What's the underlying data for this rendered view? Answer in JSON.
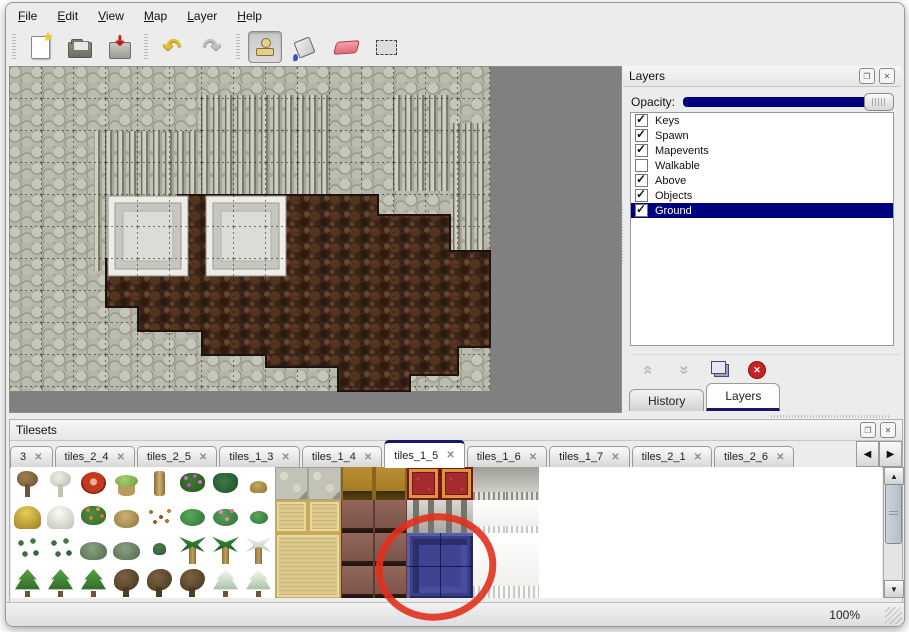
{
  "window": {
    "zoom_level": "100%"
  },
  "menu_bar": {
    "items": [
      "File",
      "Edit",
      "View",
      "Map",
      "Layer",
      "Help"
    ]
  },
  "toolbar": {
    "groups": [
      {
        "buttons": [
          {
            "icon": "new-file"
          },
          {
            "icon": "open-folder"
          },
          {
            "icon": "save"
          }
        ]
      },
      {
        "buttons": [
          {
            "icon": "undo",
            "glyph": "↶"
          },
          {
            "icon": "redo",
            "glyph": "↷"
          }
        ]
      },
      {
        "buttons": [
          {
            "icon": "stamp",
            "pressed": true
          },
          {
            "icon": "bucket"
          },
          {
            "icon": "eraser"
          },
          {
            "icon": "select"
          }
        ]
      }
    ]
  },
  "layers_panel": {
    "title": "Layers",
    "opacity_label": "Opacity:",
    "opacity_value": 1.0,
    "layers": [
      {
        "name": "Keys",
        "checked": true,
        "selected": false
      },
      {
        "name": "Spawn",
        "checked": true,
        "selected": false
      },
      {
        "name": "Mapevents",
        "checked": true,
        "selected": false
      },
      {
        "name": "Walkable",
        "checked": false,
        "selected": false
      },
      {
        "name": "Above",
        "checked": true,
        "selected": false
      },
      {
        "name": "Objects",
        "checked": true,
        "selected": false
      },
      {
        "name": "Ground",
        "checked": true,
        "selected": true
      }
    ],
    "buttons": [
      {
        "icon": "raise-layer",
        "disabled": true
      },
      {
        "icon": "lower-layer",
        "disabled": true
      },
      {
        "icon": "duplicate-layer",
        "disabled": false
      },
      {
        "icon": "delete-layer",
        "disabled": false
      }
    ],
    "tabs": [
      {
        "label": "History",
        "active": false
      },
      {
        "label": "Layers",
        "active": true
      }
    ]
  },
  "tilesets_panel": {
    "title": "Tilesets",
    "tabs": [
      {
        "label": "3",
        "active": false
      },
      {
        "label": "tiles_2_4",
        "active": false
      },
      {
        "label": "tiles_2_5",
        "active": false
      },
      {
        "label": "tiles_1_3",
        "active": false
      },
      {
        "label": "tiles_1_4",
        "active": false
      },
      {
        "label": "tiles_1_5",
        "active": true
      },
      {
        "label": "tiles_1_6",
        "active": false
      },
      {
        "label": "tiles_1_7",
        "active": false
      },
      {
        "label": "tiles_2_1",
        "active": false
      },
      {
        "label": "tiles_2_6",
        "active": false
      }
    ],
    "close_glyph": "✕",
    "scroll_left": "◀",
    "scroll_right": "▶"
  },
  "tileset_grid": {
    "tile_size": 33,
    "tiles": [
      {
        "c": 0,
        "r": 0,
        "t": "tree_dead"
      },
      {
        "c": 1,
        "r": 0,
        "t": "tree_white"
      },
      {
        "c": 2,
        "r": 0,
        "t": "bloom_red"
      },
      {
        "c": 3,
        "r": 0,
        "t": "stump"
      },
      {
        "c": 4,
        "r": 0,
        "t": "trunk"
      },
      {
        "c": 5,
        "r": 0,
        "t": "flowers_purple"
      },
      {
        "c": 6,
        "r": 0,
        "t": "fern"
      },
      {
        "c": 7,
        "r": 0,
        "t": "weed"
      },
      {
        "c": 0,
        "r": 1,
        "t": "hay"
      },
      {
        "c": 1,
        "r": 1,
        "t": "snow_mound"
      },
      {
        "c": 2,
        "r": 1,
        "t": "flowers_orange"
      },
      {
        "c": 3,
        "r": 1,
        "t": "dry_grass"
      },
      {
        "c": 4,
        "r": 1,
        "t": "leaves"
      },
      {
        "c": 5,
        "r": 1,
        "t": "lilypad"
      },
      {
        "c": 6,
        "r": 1,
        "t": "flowers_pink"
      },
      {
        "c": 7,
        "r": 1,
        "t": "lilypad_sm"
      },
      {
        "c": 0,
        "r": 2,
        "t": "sprigs"
      },
      {
        "c": 1,
        "r": 2,
        "t": "sprigs"
      },
      {
        "c": 2,
        "r": 2,
        "t": "bush"
      },
      {
        "c": 3,
        "r": 2,
        "t": "bush"
      },
      {
        "c": 4,
        "r": 2,
        "t": "sprig"
      },
      {
        "c": 5,
        "r": 2,
        "t": "palm"
      },
      {
        "c": 6,
        "r": 2,
        "t": "palm"
      },
      {
        "c": 7,
        "r": 2,
        "t": "palm_snow"
      },
      {
        "c": 0,
        "r": 3,
        "t": "pine"
      },
      {
        "c": 1,
        "r": 3,
        "t": "pine"
      },
      {
        "c": 2,
        "r": 3,
        "t": "pine"
      },
      {
        "c": 3,
        "r": 3,
        "t": "tree_gnarl"
      },
      {
        "c": 4,
        "r": 3,
        "t": "tree_gnarl"
      },
      {
        "c": 5,
        "r": 3,
        "t": "tree_gnarl"
      },
      {
        "c": 6,
        "r": 3,
        "t": "pine_snow"
      },
      {
        "c": 7,
        "r": 3,
        "t": "pine_snow"
      },
      {
        "c": 8,
        "r": 0,
        "t": "stone"
      },
      {
        "c": 9,
        "r": 0,
        "t": "stone"
      },
      {
        "c": 10,
        "r": 0,
        "t": "wood"
      },
      {
        "c": 11,
        "r": 0,
        "t": "wood"
      },
      {
        "c": 12,
        "r": 0,
        "t": "carpet"
      },
      {
        "c": 13,
        "r": 0,
        "t": "carpet"
      },
      {
        "c": 14,
        "r": 0,
        "t": "curtain_gray"
      },
      {
        "c": 15,
        "r": 0,
        "t": "curtain_gray"
      },
      {
        "c": 8,
        "r": 1,
        "t": "tatami"
      },
      {
        "c": 9,
        "r": 1,
        "t": "tatami"
      },
      {
        "c": 10,
        "r": 1,
        "t": "table"
      },
      {
        "c": 11,
        "r": 1,
        "t": "table"
      },
      {
        "c": 12,
        "r": 1,
        "t": "pillar"
      },
      {
        "c": 13,
        "r": 1,
        "t": "pillar"
      },
      {
        "c": 14,
        "r": 1,
        "t": "curtain_white"
      },
      {
        "c": 15,
        "r": 1,
        "t": "curtain_white"
      },
      {
        "c": 8,
        "r": 2,
        "w": 2,
        "h": 2,
        "t": "tatami_big"
      },
      {
        "c": 10,
        "r": 2,
        "t": "table"
      },
      {
        "c": 11,
        "r": 2,
        "t": "table"
      },
      {
        "c": 12,
        "r": 2,
        "w": 2,
        "h": 2,
        "t": "blue_sel",
        "selected": true
      },
      {
        "c": 14,
        "r": 2,
        "w": 2,
        "h": 2,
        "t": "curtain_white_big"
      },
      {
        "c": 10,
        "r": 3,
        "t": "table"
      },
      {
        "c": 11,
        "r": 3,
        "t": "table"
      }
    ]
  },
  "map": {
    "content_width": 480,
    "content_height": 324,
    "cliffs": [
      {
        "x": 84,
        "y": 64,
        "w": 104,
        "h": 140
      },
      {
        "x": 188,
        "y": 28,
        "w": 132,
        "h": 116
      },
      {
        "x": 382,
        "y": 28,
        "w": 58,
        "h": 96
      },
      {
        "x": 440,
        "y": 56,
        "w": 34,
        "h": 180
      }
    ],
    "dirt_path": "M168,128 H368 V148 H440 V184 H480 V280 H448 V308 H400 V324 H328 V300 H256 V288 H192 V264 H128 V240 H96 V192 H136 V160 H168 Z",
    "platforms": [
      {
        "x": 98,
        "y": 129,
        "size": 80
      },
      {
        "x": 196,
        "y": 129,
        "size": 80
      }
    ]
  },
  "annotation": {
    "shape": "ellipse",
    "cx": 430,
    "cy": 564,
    "rx": 57,
    "ry": 50,
    "stroke": "#e2301c",
    "stroke_width": 7,
    "rotate": -10
  },
  "colors": {
    "selection_navy": "#00007e",
    "tab_accent_navy": "#16166a",
    "canvas_gray": "#808080",
    "rock_gray": "#b5b5a8",
    "dirt_brown": "#3a2418",
    "selected_tile_blue": "#3e4392",
    "annotation_red": "#e2301c"
  }
}
